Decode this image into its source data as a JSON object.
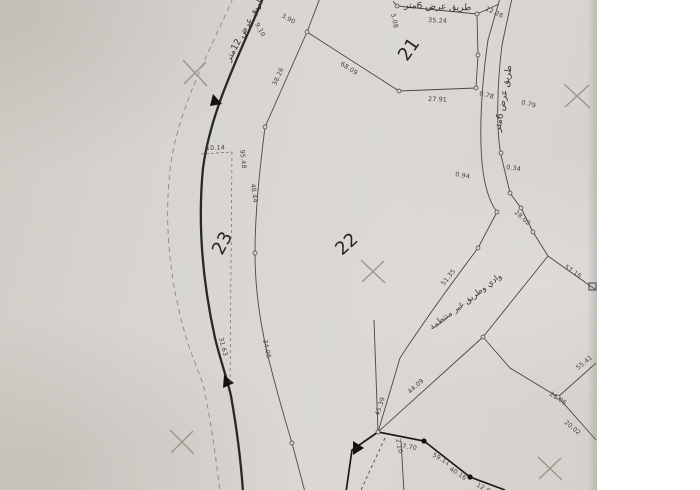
{
  "scene": {
    "paper_color": "#d8d5d0",
    "line_color": "#3f3c38",
    "dark_line_color": "#22201c",
    "cross_color": "#9a958d"
  },
  "parcels": [
    {
      "number": "21"
    },
    {
      "number": "22"
    },
    {
      "number": "23"
    }
  ],
  "road_labels": {
    "top": "طريق عرض 6متر",
    "left": "طريق عرض 12متر",
    "right": "طريق عرض 6متر",
    "wadi": "وادي وطريق غير منتظمة"
  },
  "measurements": [
    "35.24",
    "5.08",
    "12.26",
    "3.90",
    "9.10",
    "38.26",
    "68.09",
    "27.91",
    "0.78",
    "0.79",
    "0.94",
    "0.34",
    "28.02",
    "10.14",
    "95.48",
    "48.44",
    "31.63",
    "34.06",
    "45.39",
    "44.09",
    "7.70",
    "59.11",
    "40.16",
    "12.8",
    "57.16",
    "55.41",
    "26.06",
    "20.02",
    "2.10",
    "51.35"
  ]
}
